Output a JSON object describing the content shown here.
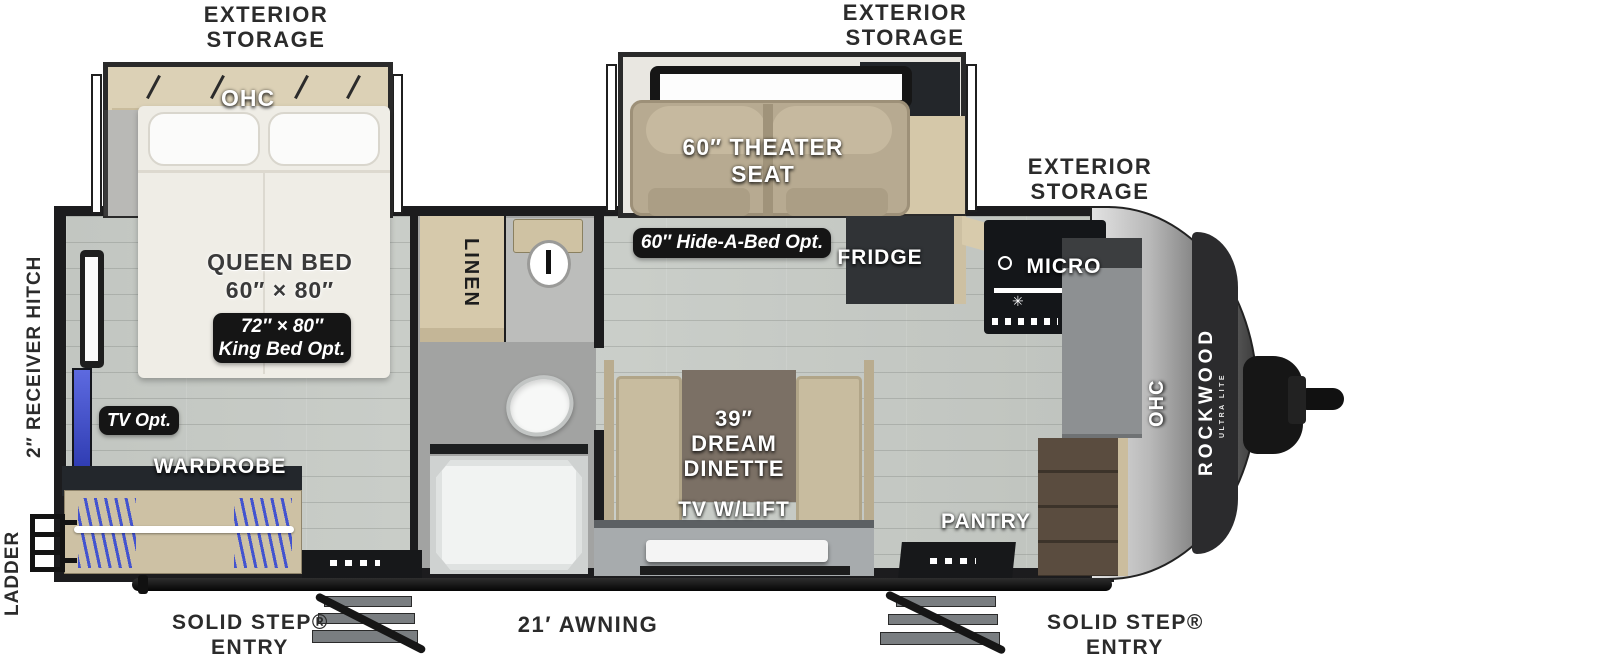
{
  "plan_title": "Rockwood Ultra Lite travel trailer floorplan",
  "brand": {
    "name": "ROCKWOOD",
    "sub": "ULTRA LITE"
  },
  "colors": {
    "label_dark": "#2b2b2b",
    "badge_bg": "#151515",
    "wall": "#1c1c1e",
    "floor_gray": "#c7cbc6",
    "cabinet_tan": "#d5c8a9",
    "seat_tan": "#b4a78e",
    "tv_blue": "#4353cf",
    "cap_silver": "#9a9a9a"
  },
  "labels": {
    "exterior_storage_rear": {
      "line1": "EXTERIOR",
      "line2": "STORAGE"
    },
    "exterior_storage_mid": {
      "line1": "EXTERIOR",
      "line2": "STORAGE"
    },
    "exterior_storage_front": {
      "line1": "EXTERIOR",
      "line2": "STORAGE"
    },
    "ohc_bedroom": "OHC",
    "queen_bed": {
      "line1": "QUEEN BED",
      "line2": "60″ × 80″"
    },
    "king_bed_opt": {
      "line1": "72″ × 80″",
      "line2": "King Bed Opt."
    },
    "tv_opt": "TV Opt.",
    "wardrobe": "WARDROBE",
    "receiver_hitch": "2″ RECEIVER HITCH",
    "ladder": "LADDER",
    "linen": "LINEN",
    "theater_seat": {
      "line1": "60″ THEATER",
      "line2": "SEAT"
    },
    "hide_a_bed": "60″ Hide-A-Bed Opt.",
    "fridge": "FRIDGE",
    "micro": "MICRO",
    "dinette": {
      "line1": "39″",
      "line2": "DREAM",
      "line3": "DINETTE"
    },
    "tv_lift": "TV W/LIFT",
    "pantry": "PANTRY",
    "ohc_front": "OHC",
    "solid_step_left": {
      "line1": "SOLID STEP®",
      "line2": "ENTRY"
    },
    "solid_step_right": {
      "line1": "SOLID STEP®",
      "line2": "ENTRY"
    },
    "awning": "21′ AWNING"
  }
}
